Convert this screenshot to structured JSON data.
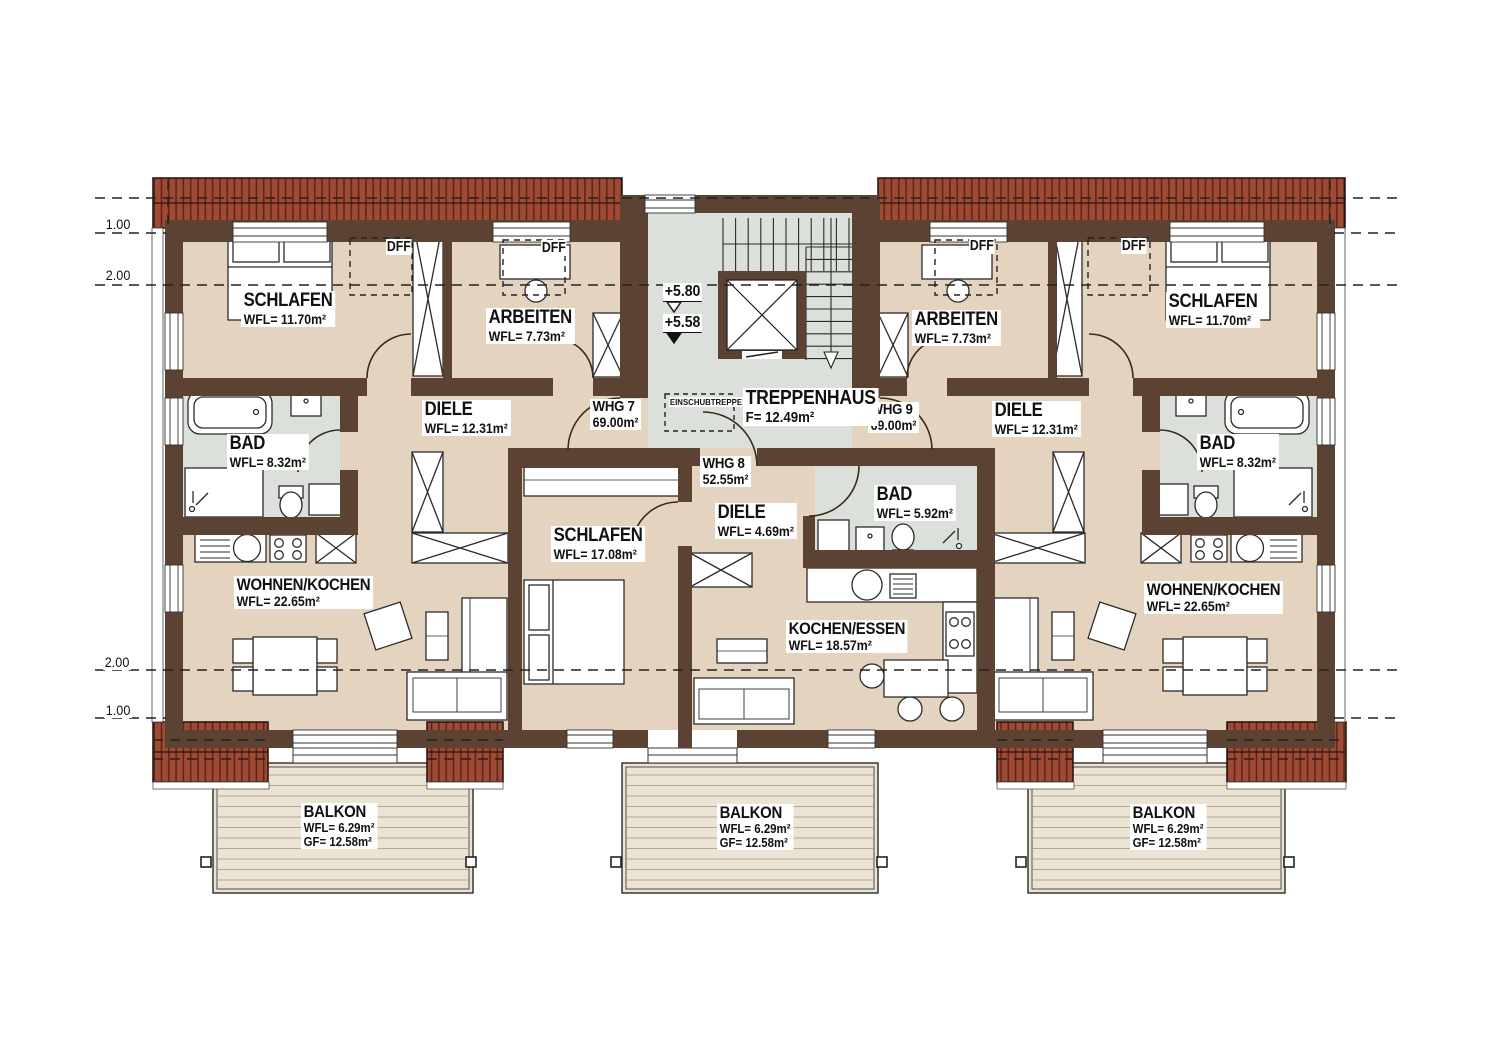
{
  "plan": {
    "dimension_marks": {
      "top": [
        "1.00",
        "2.00"
      ],
      "bottom": [
        "2.00",
        "1.00"
      ]
    },
    "levels": {
      "upper": "+5.80",
      "lower": "+5.58"
    },
    "stairwell": {
      "name": "TREPPENHAUS",
      "area": "F= 12.49m²",
      "insert_stair": "EINSCHUBTREPPE"
    },
    "skylights": [
      "DFF",
      "DFF",
      "DFF",
      "DFF"
    ],
    "apartments": [
      {
        "id": "WHG 7",
        "area": "69.00m²",
        "rooms": [
          {
            "name": "SCHLAFEN",
            "area": "WFL= 11.70m²"
          },
          {
            "name": "ARBEITEN",
            "area": "WFL= 7.73m²"
          },
          {
            "name": "DIELE",
            "area": "WFL= 12.31m²"
          },
          {
            "name": "BAD",
            "area": "WFL= 8.32m²"
          },
          {
            "name": "WOHNEN/KOCHEN",
            "area": "WFL= 22.65m²"
          }
        ]
      },
      {
        "id": "WHG 8",
        "area": "52.55m²",
        "rooms": [
          {
            "name": "SCHLAFEN",
            "area": "WFL= 17.08m²"
          },
          {
            "name": "DIELE",
            "area": "WFL= 4.69m²"
          },
          {
            "name": "BAD",
            "area": "WFL= 5.92m²"
          },
          {
            "name": "KOCHEN/ESSEN",
            "area": "WFL= 18.57m²"
          }
        ]
      },
      {
        "id": "WHG 9",
        "area": "69.00m²",
        "rooms": [
          {
            "name": "ARBEITEN",
            "area": "WFL= 7.73m²"
          },
          {
            "name": "SCHLAFEN",
            "area": "WFL= 11.70m²"
          },
          {
            "name": "DIELE",
            "area": "WFL= 12.31m²"
          },
          {
            "name": "BAD",
            "area": "WFL= 8.32m²"
          },
          {
            "name": "WOHNEN/KOCHEN",
            "area": "WFL= 22.65m²"
          }
        ]
      }
    ],
    "balconies": [
      {
        "name": "BALKON",
        "wfl": "WFL= 6.29m²",
        "gf": "GF= 12.58m²"
      },
      {
        "name": "BALKON",
        "wfl": "WFL= 6.29m²",
        "gf": "GF= 12.58m²"
      },
      {
        "name": "BALKON",
        "wfl": "WFL= 6.29m²",
        "gf": "GF= 12.58m²"
      }
    ],
    "colors": {
      "wall": "#5b4232",
      "floor": "#e4d4bf",
      "wet_floor": "#dce0da",
      "roof": "#a04a33",
      "balcony": "#ebe3d3"
    }
  }
}
